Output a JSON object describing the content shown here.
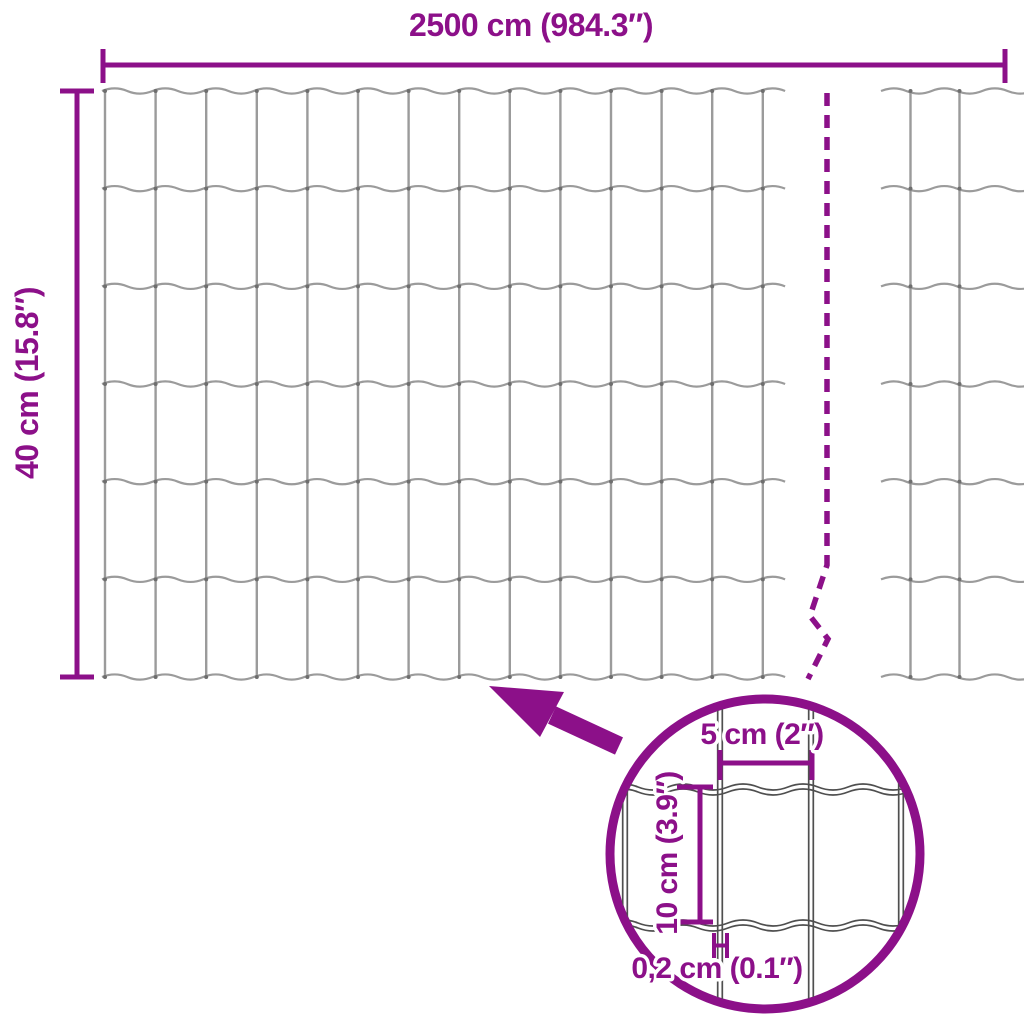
{
  "diagram": {
    "type": "product-dimension-diagram",
    "subject": "wire mesh garden fence roll",
    "labels": {
      "total_width": "2500 cm (984.3″)",
      "total_height": "40 cm (15.8″)"
    },
    "detail": {
      "mesh_opening_width": "5 cm (2″)",
      "mesh_opening_height": "10 cm (3.9″)",
      "wire_thickness": "0,2 cm (0.1″)"
    },
    "colors": {
      "accent": "#8C1089",
      "wire": "#9B9B9B",
      "wire_knot": "#6E6E6E",
      "detail_wire": "#4F4F4F",
      "background": "#FFFFFF"
    }
  }
}
